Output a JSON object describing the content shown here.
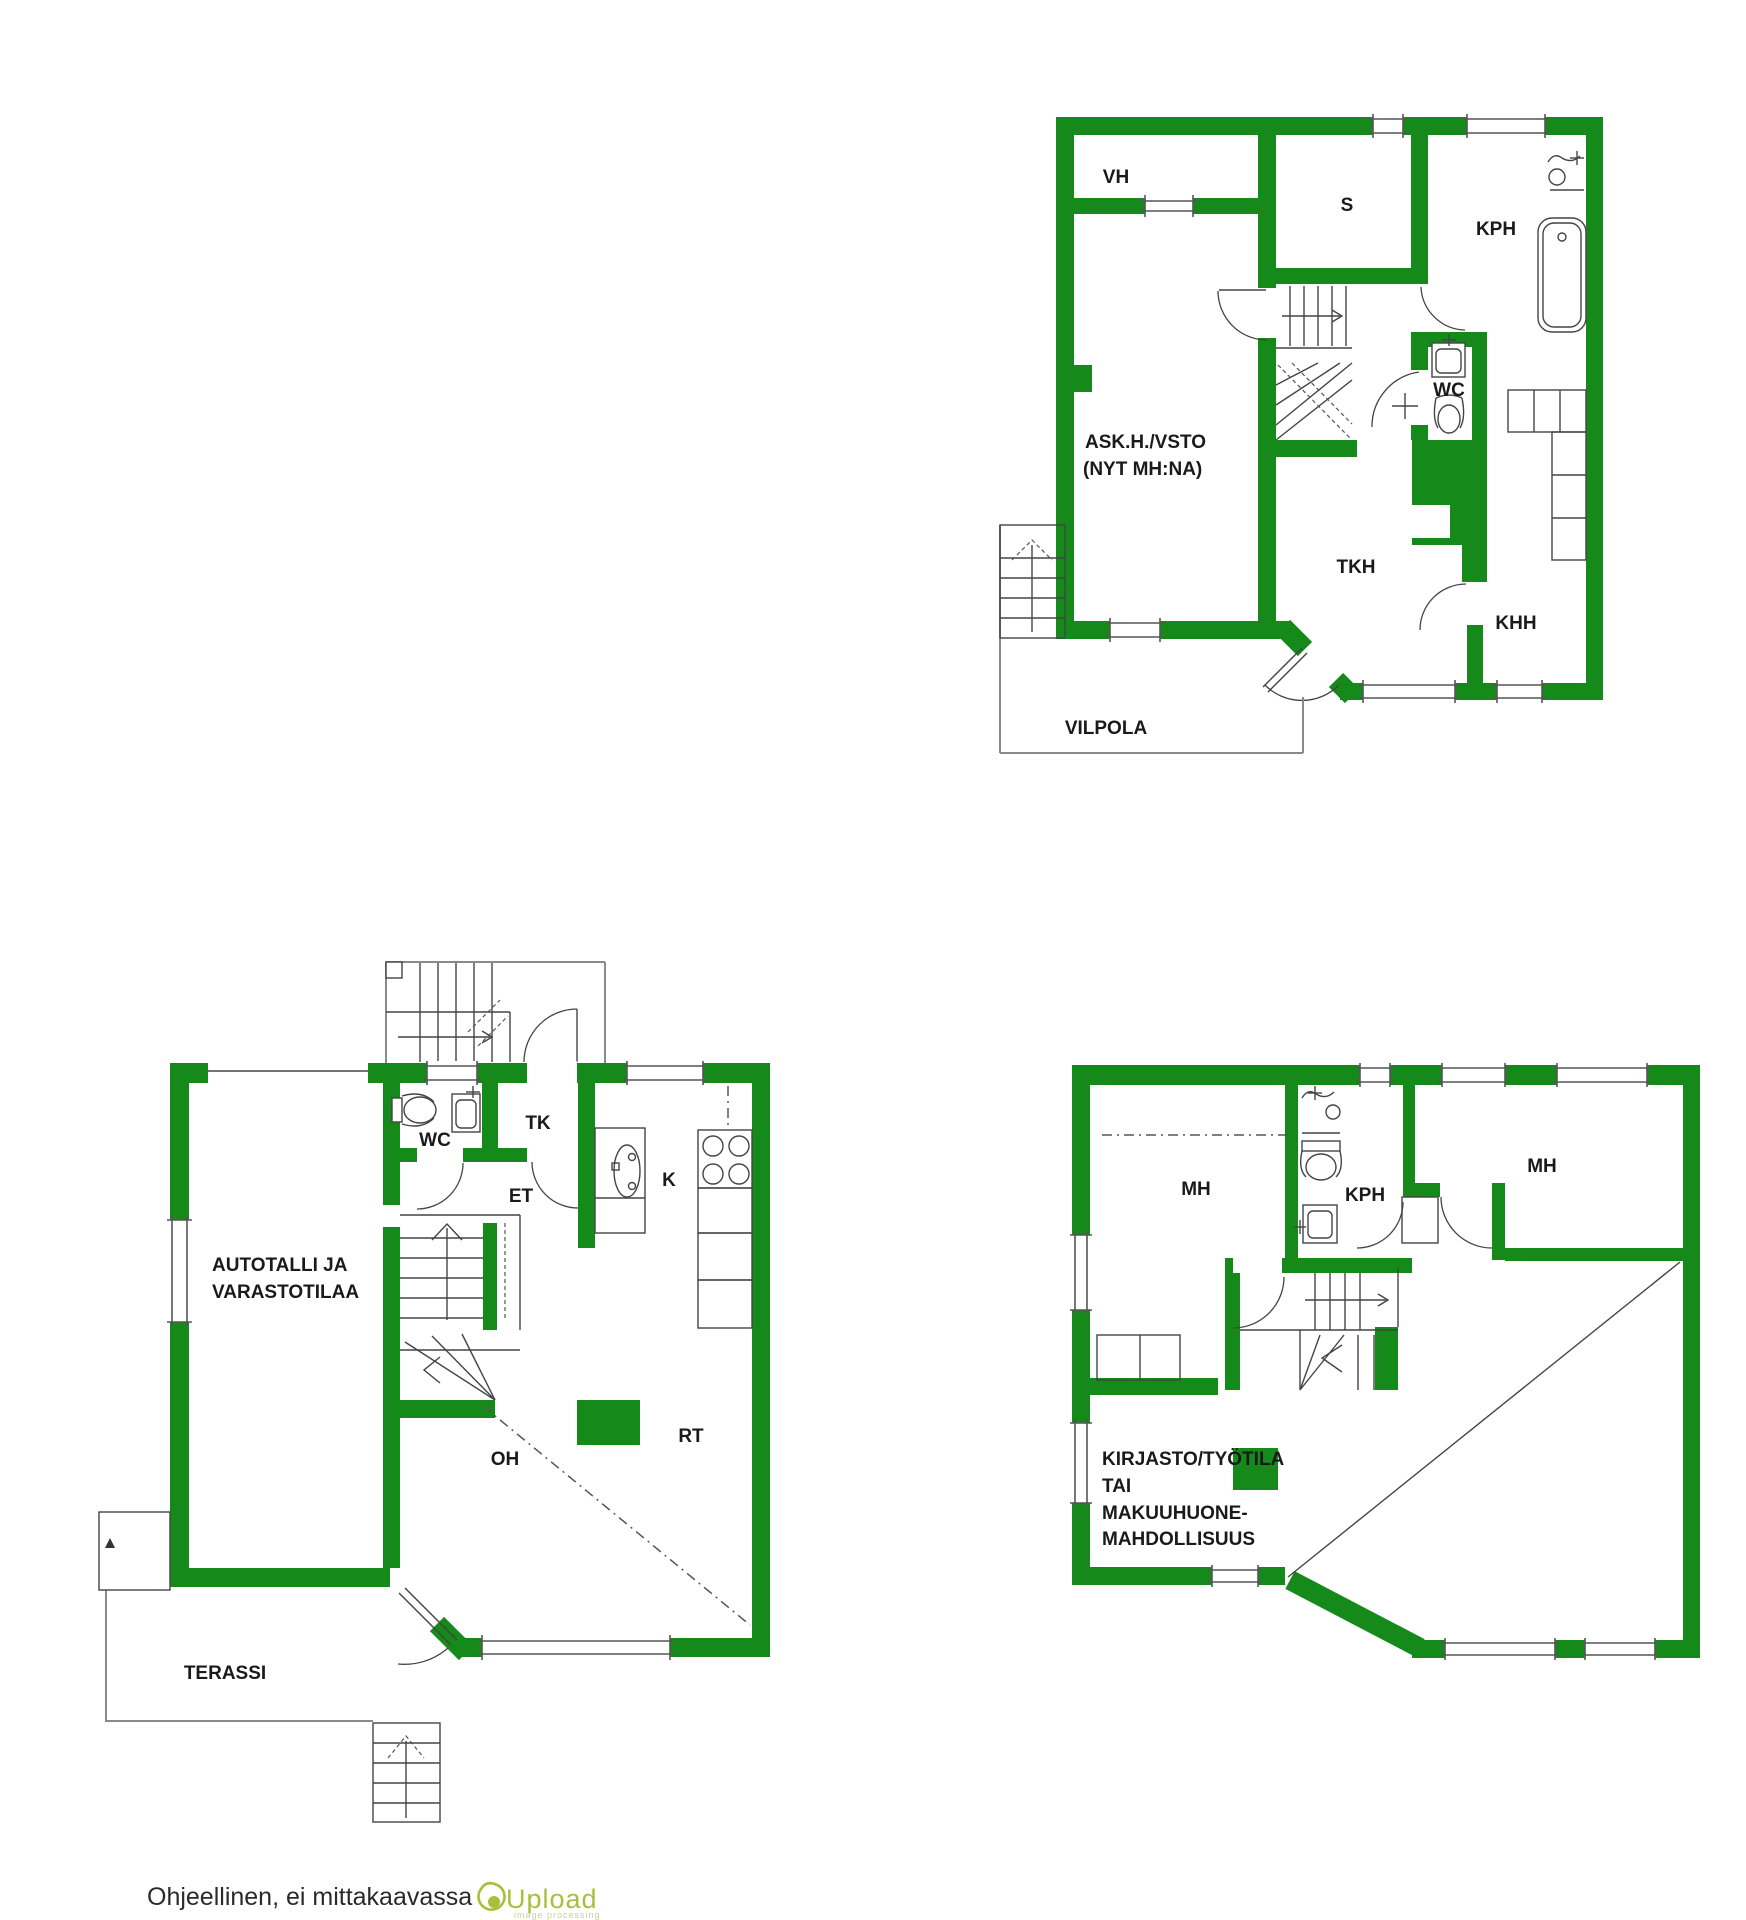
{
  "colors": {
    "wall_green": "#158a1a",
    "thin_line": "#444444",
    "porch_gray": "#8a8a8a",
    "label_text": "#1a1a1a",
    "logo_green": "#a9bf3b",
    "logo_light_green": "#c7d296"
  },
  "plan_upper": {
    "rooms": {
      "vh": "VH",
      "s": "S",
      "kph": "KPH",
      "wc": "WC",
      "askh_line1": "ASK.H./VSTO",
      "askh_line2": "(NYT MH:NA)",
      "tkh": "TKH",
      "khh": "KHH",
      "vilpola": "VILPOLA"
    }
  },
  "plan_ground": {
    "rooms": {
      "wc": "WC",
      "tk": "TK",
      "et": "ET",
      "k": "K",
      "garage_line1": "AUTOTALLI JA",
      "garage_line2": "VARASTOTILAA",
      "oh": "OH",
      "rt": "RT",
      "terassi": "TERASSI"
    }
  },
  "plan_loft": {
    "rooms": {
      "mh_left": "MH",
      "kph": "KPH",
      "mh_right": "MH",
      "library_line1": "KIRJASTO/TYÖTILA",
      "library_line2": "TAI",
      "library_line3": "MAKUUHUONE-",
      "library_line4": "MAHDOLLISUUS"
    }
  },
  "footer": {
    "note": "Ohjeellinen, ei mittakaavassa",
    "logo_text": "Upload",
    "logo_subtext": "image processing"
  }
}
